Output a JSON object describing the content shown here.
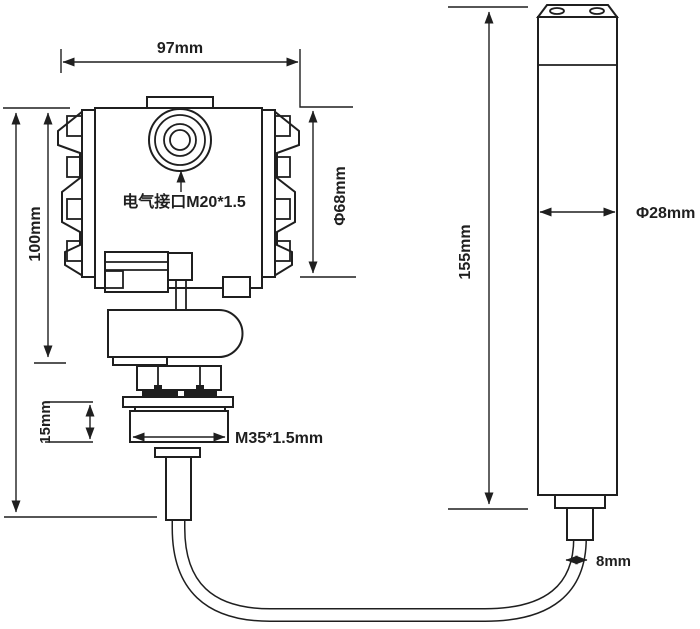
{
  "diagram": {
    "background": "#ffffff",
    "line_color": "#1f1f1f",
    "transmitter": {
      "width_label": "97mm",
      "height_label": "100mm",
      "diameter_label": "Φ68mm",
      "electrical_interface_label": "电气接口M20*1.5",
      "neck_height_label": "15mm",
      "thread_label": "M35*1.5mm"
    },
    "probe": {
      "length_label": "155mm",
      "diameter_label": "Φ28mm",
      "cable_diameter_label": "8mm"
    }
  }
}
